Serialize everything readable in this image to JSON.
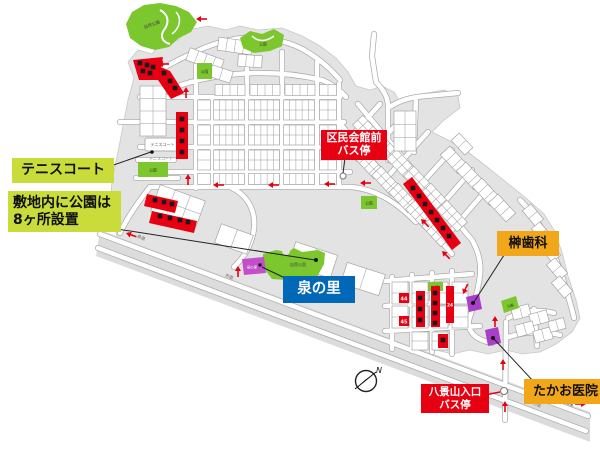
{
  "callouts": {
    "tennis_court": {
      "label": "テニスコート"
    },
    "parks_note": {
      "line1": "敷地内に公園は",
      "line2": "8ヶ所設置"
    },
    "kumin_kaikan_bus": {
      "line1": "区民会館前",
      "line2": "バス停"
    },
    "sakaki_dental": {
      "label": "榊歯科"
    },
    "izumi_no_sato": {
      "label": "泉の里"
    },
    "hakkeizan_bus": {
      "line1": "八景山入口",
      "line2": "バス停"
    },
    "takao_clinic": {
      "label": "たかお医院"
    }
  },
  "map_texts": {
    "nature_park_upper": "自然公園",
    "nature_park_lower": "自然公園",
    "park": "公園",
    "tennis_court_box": "テニスコート",
    "tennis_court_sub": "テニスコート",
    "izumi_block": "泉の里",
    "prefectural_road": "県道",
    "city_road": "市道",
    "city_road_2": "市道",
    "yukuhashi_city_road": "行橋市道",
    "lot_44": "44",
    "lot_45": "45",
    "lot_24": "24",
    "compass_north": "N"
  },
  "colors": {
    "park_green": "#7CC62E",
    "label_lime": "#C9DC3A",
    "label_red": "#E60012",
    "label_blue": "#0068B7",
    "label_orange": "#F2A71B",
    "lot_red": "#E60012",
    "sold_marker_black": "#1A1A1A",
    "facility_magenta": "#C24FC9",
    "terrain_gray": "#E3E3E3"
  }
}
